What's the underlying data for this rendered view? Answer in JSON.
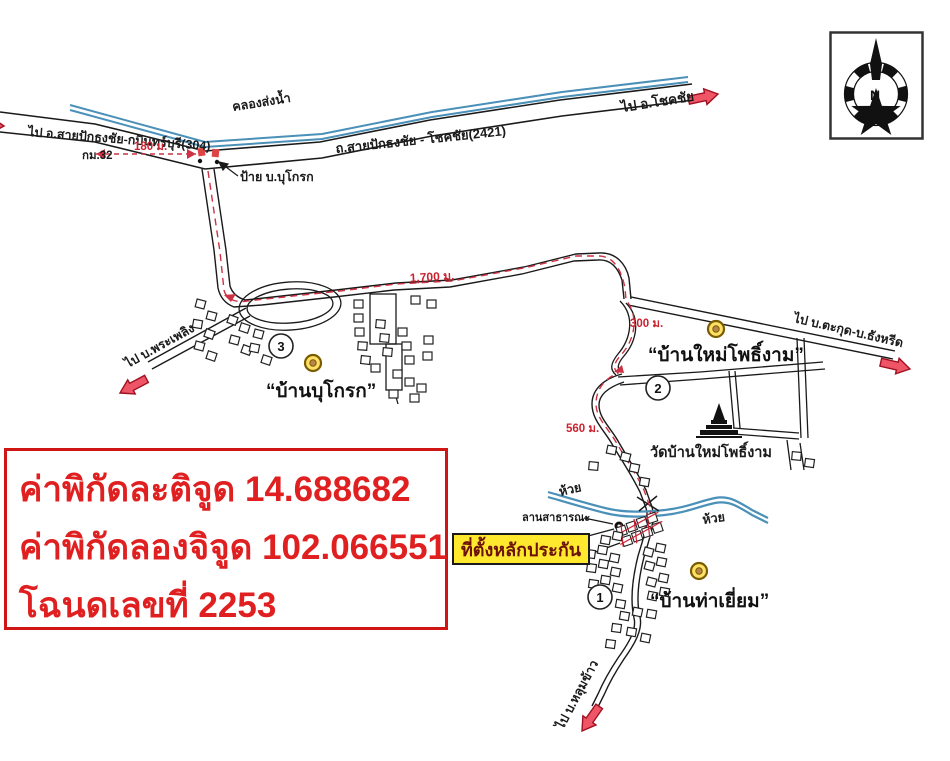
{
  "info_box": {
    "line1": "ค่าพิกัดละติจูด 14.688682",
    "line2": "ค่าพิกัดลองจิจูด 102.066551",
    "line3": "โฉนดเลขที่ 2253"
  },
  "labels": {
    "to_304": "ไป อ.สายปักธงชัย-กบินทร์บุรี(304)",
    "canal": "คลองส่งน้ำ",
    "highway": "ถ.สายปักธงชัย - โชคชัย(2421)",
    "to_chokchai": "ไป อ.โชคชัย",
    "km32": "กม.32",
    "sign": "ป้าย บ.บุโกรก",
    "to_phraphloeng": "ไป บ.พระเพลิง",
    "to_takut": "ไป บ.ตะกุด-บ.ธังหรีด",
    "to_lumkhao": "ไป บ.หลุมข้าว",
    "lan_satharana": "ลานสาธารณะ",
    "huai_left": "ห้วย",
    "huai_right": "ห้วย",
    "temple": "วัดบ้านใหม่โพธิ์งาม",
    "collateral": "ที่ตั้งหลักประกัน"
  },
  "villages": {
    "bukrok": "“บ้านบุโกรก”",
    "maipho": "“บ้านใหม่โพธิ์งาม”",
    "thayiam": "“บ้านท่าเยี่ยม”"
  },
  "distances": {
    "d180": "180 ม.",
    "d1700": "1,700 ม.",
    "d300": "300 ม.",
    "d560": "560 ม."
  },
  "markers": {
    "m1": "1",
    "m2": "2",
    "m3": "3"
  },
  "compass": {
    "north": "N"
  },
  "colors": {
    "road": "#1a1a1a",
    "water": "#4a90b8",
    "distance_red": "#cc2230",
    "arrow_fill": "#ee5566",
    "arrow_stroke": "#a01020",
    "highlight_yellow": "#ffe92e",
    "info_red": "#e02020"
  }
}
